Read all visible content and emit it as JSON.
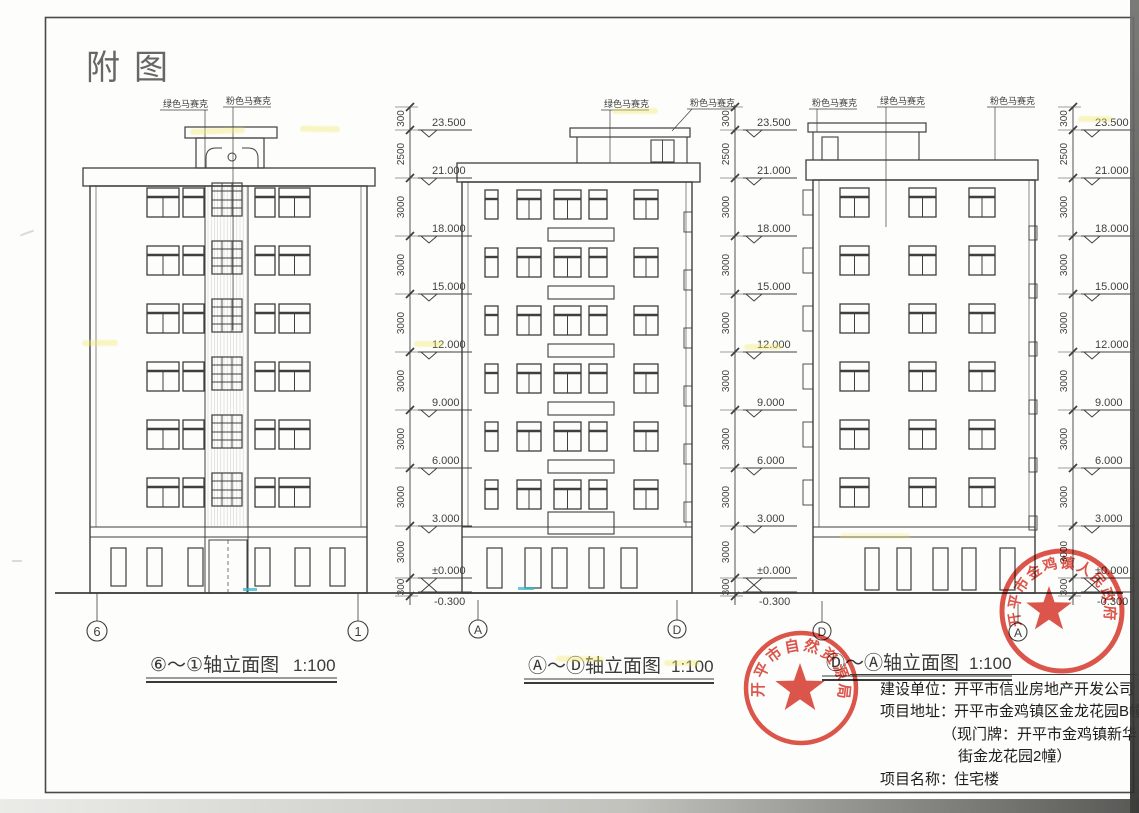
{
  "page": {
    "title": "附图"
  },
  "colors": {
    "ink": "#3f3f3f",
    "stamp_red": "#d7372c",
    "highlight_yellow": "#f2e96b",
    "highlight_cyan": "#35b8cc"
  },
  "materials": {
    "green_mosaic": "绿色马赛克",
    "pink_mosaic": "粉色马赛克"
  },
  "dimensions": {
    "segments": [
      "300",
      "2500",
      "3000",
      "3000",
      "3000",
      "3000",
      "3000",
      "3000",
      "3000",
      "300"
    ],
    "elevations": [
      "23.500",
      "21.000",
      "18.000",
      "15.000",
      "12.000",
      "9.000",
      "6.000",
      "3.000",
      "±0.000",
      "-0.300"
    ]
  },
  "views": [
    {
      "title": "⑥～①轴立面图",
      "scale": "1:100",
      "axis_left": "6",
      "axis_right": "1"
    },
    {
      "title": "Ⓐ～Ⓓ轴立面图",
      "scale": "1:100",
      "axis_left": "A",
      "axis_right": "D"
    },
    {
      "title": "Ⓓ～Ⓐ轴立面图",
      "scale": "1:100",
      "axis_left": "D",
      "axis_right": "A"
    }
  ],
  "stamps": [
    {
      "text": "开平市自然资源局"
    },
    {
      "text": "开平市金鸡镇人民政府"
    }
  ],
  "project_info": {
    "rows": [
      {
        "label": "建设单位：",
        "value": "开平市信业房地产开发公司"
      },
      {
        "label": "项目地址：",
        "value": "开平市金鸡镇区金龙花园B幢"
      },
      {
        "label": "",
        "value": "（现门牌：开平市金鸡镇新华"
      },
      {
        "label": "",
        "value": "街金龙花园2幢）"
      },
      {
        "label": "项目名称：",
        "value": "住宅楼"
      }
    ]
  }
}
